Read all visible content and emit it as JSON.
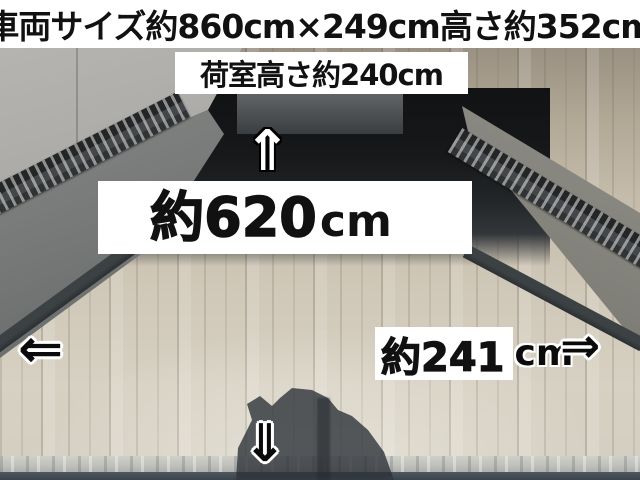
{
  "banners": {
    "vehicle_size": "車両サイズ約860cm×249cm高さ約352cm",
    "cargo_height": "荷室高さ約240cm"
  },
  "dimensions": {
    "length": {
      "value": "約620",
      "unit": "cm"
    },
    "width": {
      "value": "約241",
      "unit": "cm"
    }
  },
  "icons": {
    "up_arrow": "⇑",
    "down_arrow": "⇓",
    "left_arrow": "⇐",
    "right_arrow": "⇒"
  },
  "colors": {
    "banner_bg": "#ffffff",
    "banner_text": "#111111",
    "floor_wood": "#cfc7b7",
    "wall_gray": "#a9a8a5",
    "cargo_shadow": "#16181a"
  }
}
